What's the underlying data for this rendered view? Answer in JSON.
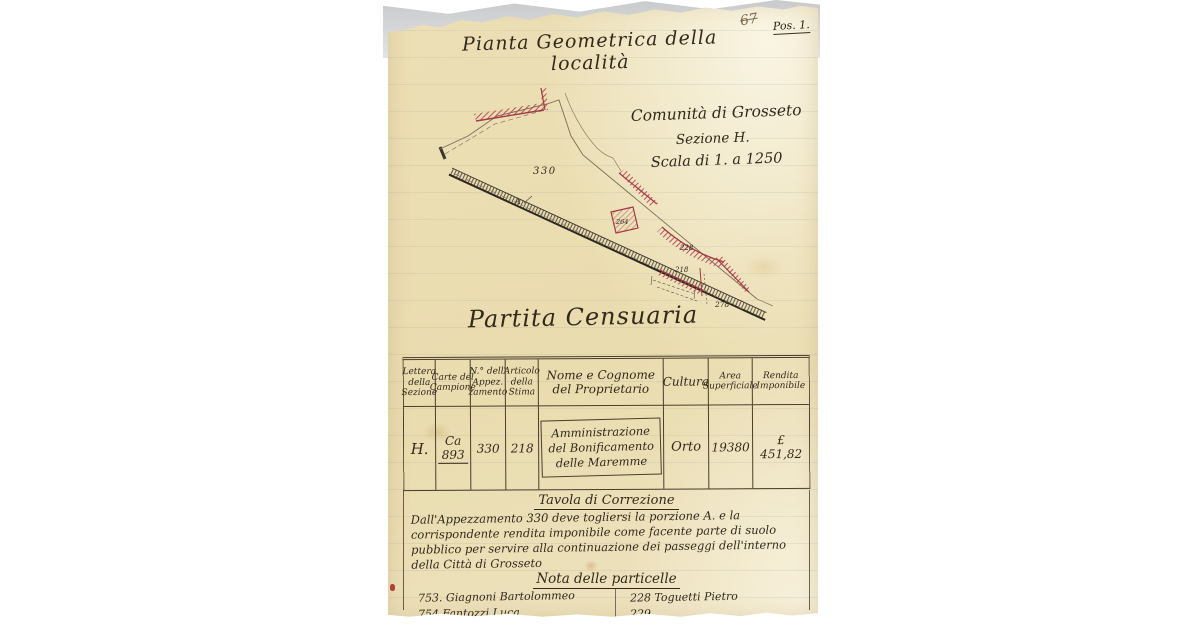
{
  "corner": {
    "pencil_number": "67",
    "file_label": "Pos. 1."
  },
  "map": {
    "title": "Pianta Geometrica della località",
    "community": "Comunità di Grosseto",
    "section": "Sezione H.",
    "scale": "Scala di 1. a 1250",
    "labels": {
      "parcel_330": "330",
      "parcel_264": "264",
      "parcel_228": "228",
      "parcel_218": "218",
      "parcel_278": "278",
      "portion_a": "A"
    }
  },
  "census": {
    "heading": "Partita Censuaria",
    "table": {
      "headers": [
        "Lettera della Sezione",
        "Carte del Campione",
        "N.° dell' Appez. zamento",
        "Articolo della Stima",
        "Nome e Cognome del Proprietario",
        "Cultura",
        "Area Superficiale",
        "Rendita Imponibile"
      ],
      "row": [
        "H.",
        "Ca 893",
        "330",
        "218",
        "Amministrazione del Bonificamento delle Maremme",
        "Orto",
        "19380",
        "£ 451,82"
      ]
    }
  },
  "correction": {
    "heading": "Tavola di Correzione",
    "text": "Dall'Appezzamento 330 deve togliersi la porzione A. e la corrispondente rendita imponibile come facente parte di suolo pubblico per servire alla continuazione dei passeggi dell'interno della Città di Grosseto"
  },
  "note": {
    "heading": "Nota delle particelle",
    "left": [
      "753. Giagnoni Bartolommeo",
      "754 Fantozzi Luca"
    ],
    "right": [
      "228 Toguetti Pietro",
      "229"
    ]
  },
  "colors": {
    "paper": "#ecdfb6",
    "ink": "#33291b",
    "red": "#a53a44"
  }
}
